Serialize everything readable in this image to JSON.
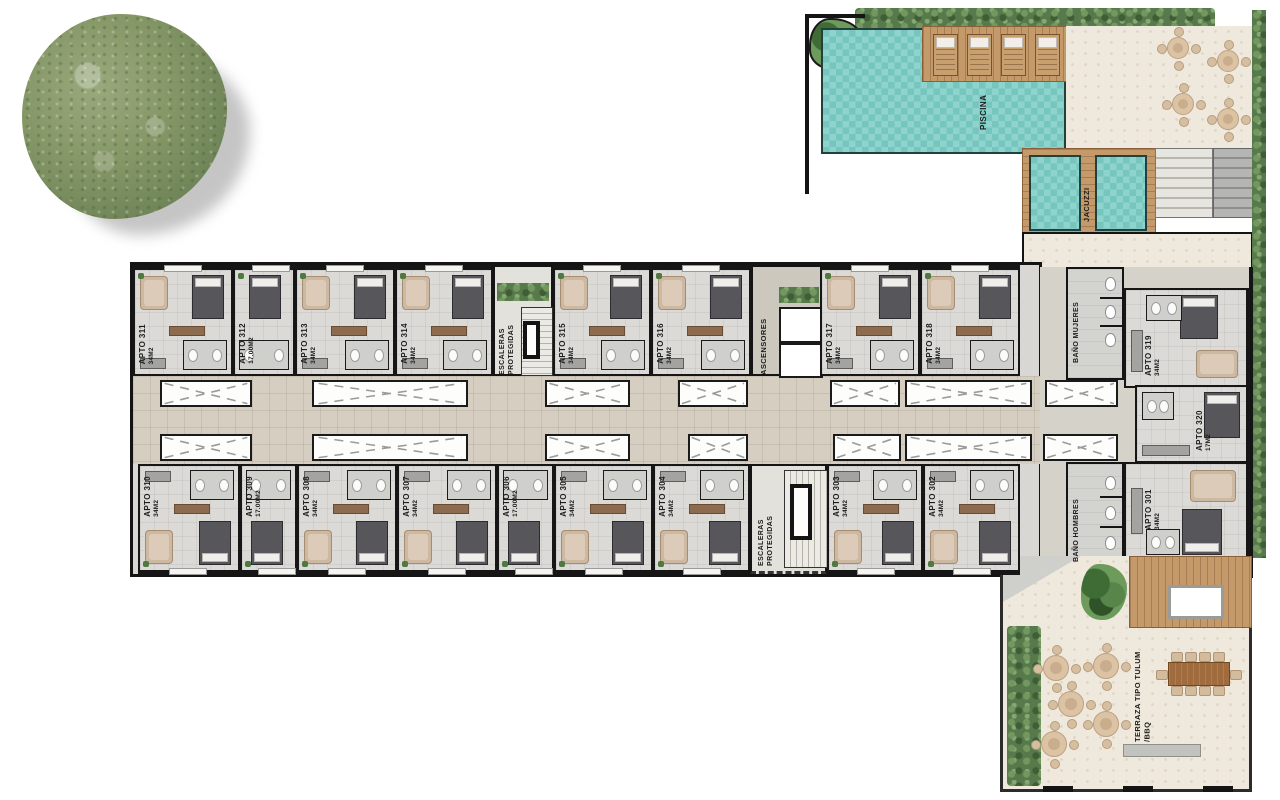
{
  "amenities": {
    "pool": "PISCINA",
    "jacuzzi": "JACUZZI",
    "elevators": "ASCENSORES",
    "stairs_line1": "ESCALERAS",
    "stairs_line2": "PROTEGIDAS",
    "bath_women": "BAÑO MUJERES",
    "bath_men": "BAÑO HOMBRES",
    "terrace_line1": "TERRAZA TIPO TULUM",
    "terrace_line2": "/BBQ"
  },
  "units_top": [
    {
      "id": "APTO 311",
      "size": "34M2"
    },
    {
      "id": "APTO 312",
      "size": "17.00M2"
    },
    {
      "id": "APTO 313",
      "size": "34M2"
    },
    {
      "id": "APTO 314",
      "size": "34M2"
    },
    {
      "id": "APTO 315",
      "size": "34M2"
    },
    {
      "id": "APTO 316",
      "size": "34M2"
    },
    {
      "id": "APTO 317",
      "size": "34M2"
    },
    {
      "id": "APTO 318",
      "size": "34M2"
    }
  ],
  "units_bottom": [
    {
      "id": "APTO 310",
      "size": "34M2"
    },
    {
      "id": "APTO 309",
      "size": "17.00M2"
    },
    {
      "id": "APTO 308",
      "size": "34M2"
    },
    {
      "id": "APTO 307",
      "size": "34M2"
    },
    {
      "id": "APTO 306",
      "size": "17.00M2"
    },
    {
      "id": "APTO 305",
      "size": "34M2"
    },
    {
      "id": "APTO 304",
      "size": "34M2"
    },
    {
      "id": "APTO 303",
      "size": "34M2"
    },
    {
      "id": "APTO 302",
      "size": "34M2"
    }
  ],
  "units_right": [
    {
      "id": "APTO 319",
      "size": "34M2"
    },
    {
      "id": "APTO 320",
      "size": "17M2"
    },
    {
      "id": "APTO 301",
      "size": "34M2"
    }
  ],
  "colors": {
    "wall": "#141414",
    "room_floor": "#dbdad7",
    "corridor_floor": "#d6cec0",
    "pool_water": "#82cdc8",
    "wood_deck": "#c59a6b",
    "hedge_green": "#567a4b",
    "terrace_cream": "#efe9dd",
    "bed_dark": "#56565b",
    "sofa_tan": "#cdb8a2"
  }
}
